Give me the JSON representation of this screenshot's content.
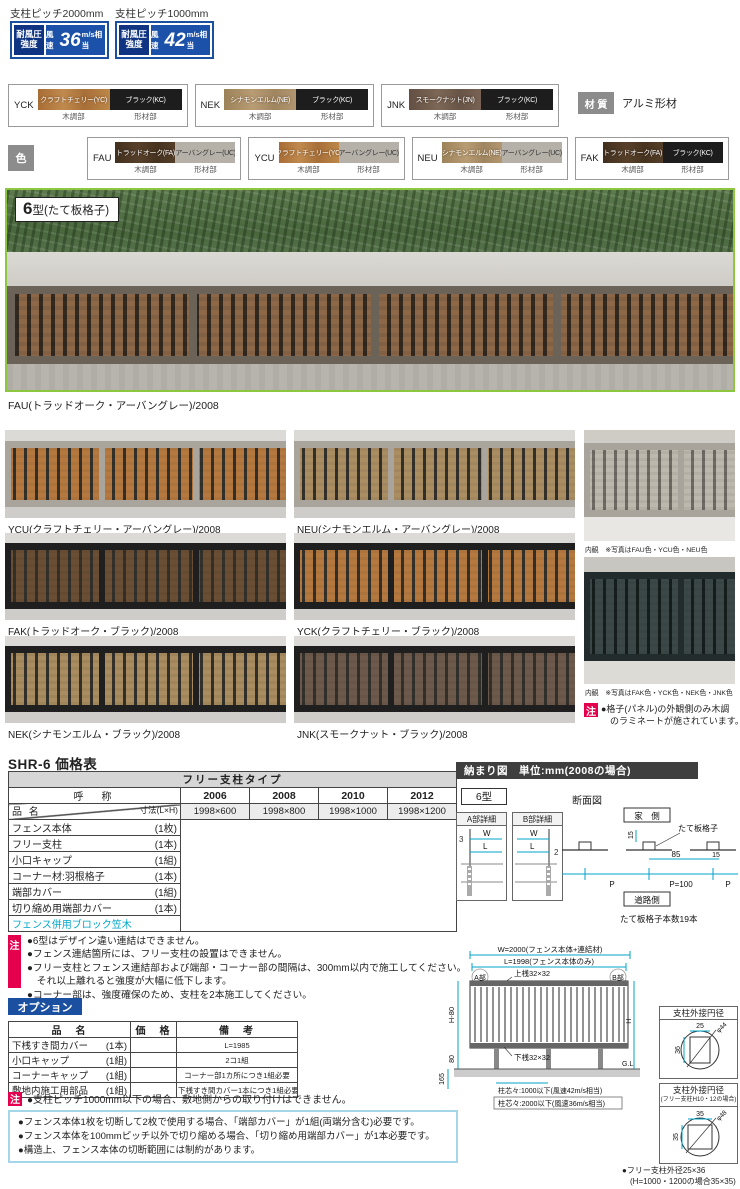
{
  "colors": {
    "badge_blue": "#1b4fa0",
    "badge_blue_dark": "#0f3582",
    "accent_red": "#e5004e",
    "link_cyan": "#00a7c9",
    "dim_cyan": "#00a3c8",
    "photo_frame_green": "#8dc63f",
    "wood_craft_cherry": "#b4793d",
    "wood_cinnamon_elm": "#ac9068",
    "wood_smoke_nut": "#6e5a4b",
    "wood_trad_oak": "#4c3826",
    "urban_gray": "#b5b1a8",
    "black_kc": "#1d1d1d"
  },
  "spec_badges": [
    {
      "pitch": "支柱ピッチ2000mm",
      "label": "耐風圧強度",
      "wind_prefix": "風速",
      "wind_value": "36",
      "wind_unit": "m/s相当"
    },
    {
      "pitch": "支柱ピッチ1000mm",
      "label": "耐風圧強度",
      "wind_prefix": "風速",
      "wind_value": "42",
      "wind_unit": "m/s相当"
    }
  ],
  "material": {
    "label": "材 質",
    "value": "アルミ形材"
  },
  "color_row_label": "色",
  "swatches_row1": [
    {
      "code": "YCK",
      "left": "クラフトチェリー(YC)",
      "right": "ブラック(KC)",
      "left_part": "木調部",
      "right_part": "形材部"
    },
    {
      "code": "NEK",
      "left": "シナモンエルム(NE)",
      "right": "ブラック(KC)",
      "left_part": "木調部",
      "right_part": "形材部"
    },
    {
      "code": "JNK",
      "left": "スモークナット(JN)",
      "right": "ブラック(KC)",
      "left_part": "木調部",
      "right_part": "形材部"
    }
  ],
  "swatches_row2": [
    {
      "code": "FAU",
      "left": "トラッドオーク(FA)",
      "right": "アーバングレー(UC)",
      "left_part": "木調部",
      "right_part": "形材部"
    },
    {
      "code": "YCU",
      "left": "クラフトチェリー(YC)",
      "right": "アーバングレー(UC)",
      "left_part": "木調部",
      "right_part": "形材部"
    },
    {
      "code": "NEU",
      "left": "シナモンエルム(NE)",
      "right": "アーバングレー(UC)",
      "left_part": "木調部",
      "right_part": "形材部"
    },
    {
      "code": "FAK",
      "left": "トラッドオーク(FA)",
      "right": "ブラック(KC)",
      "left_part": "木調部",
      "right_part": "形材部"
    }
  ],
  "series_badge": {
    "number": "6",
    "suffix": "型(たて板格子)"
  },
  "main_photo_caption": "FAU(トラッドオーク・アーバングレー)/2008",
  "photo_grid": [
    {
      "caption": "YCU(クラフトチェリー・アーバングレー)/2008"
    },
    {
      "caption": "NEU(シナモンエルム・アーバングレー)/2008"
    },
    {
      "caption": "FAK(トラッドオーク・ブラック)/2008"
    },
    {
      "caption": "YCK(クラフトチェリー・ブラック)/2008"
    },
    {
      "caption": "NEK(シナモンエルム・ブラック)/2008"
    },
    {
      "caption": "JNK(スモークナット・ブラック)/2008"
    }
  ],
  "interior": {
    "caption1": "内観　※写真はFAU色・YCU色・NEU色",
    "caption2": "内観　※写真はFAK色・YCK色・NEK色・JNK色",
    "note_badge": "注",
    "note_text1": "●格子(パネル)の外観側のみ木調",
    "note_text2": "　のラミネートが施されています。"
  },
  "price_table": {
    "title": "SHR-6 価格表",
    "type_header": "フリー支柱タイプ",
    "name_header": "呼　称",
    "size_header": "寸法(L×H)",
    "item_header": "品 名",
    "codes": [
      "2006",
      "2008",
      "2010",
      "2012"
    ],
    "sizes": [
      "1998×600",
      "1998×800",
      "1998×1000",
      "1998×1200"
    ],
    "items": [
      {
        "name": "フェンス本体",
        "unit": "(1枚)"
      },
      {
        "name": "フリー支柱",
        "unit": "(1本)"
      },
      {
        "name": "小口キャップ",
        "unit": "(1組)"
      },
      {
        "name": "コーナー材:羽根格子",
        "unit": "(1本)"
      },
      {
        "name": "端部カバー",
        "unit": "(1組)"
      },
      {
        "name": "切り縮め用端部カバー",
        "unit": "(1本)"
      }
    ],
    "link_row": "フェンス併用ブロック笠木"
  },
  "layout_diagram": {
    "header": "納まり図　単位:mm(2008の場合)",
    "type_label": "6型",
    "detail_a": {
      "title": "A部詳細",
      "dim": "3",
      "w": "W",
      "l": "L"
    },
    "detail_b": {
      "title": "B部詳細",
      "dim": "2",
      "w": "W",
      "l": "L"
    },
    "section_label": "断面図",
    "house_side": "家　側",
    "grille_label": "たて板格子",
    "dim_15a": "15",
    "dim_85": "85",
    "dim_15b": "15",
    "dim_p1": "P",
    "dim_p100": "P=100",
    "dim_p2": "P",
    "road_side": "道路側",
    "count_note": "たて板格子本数19本"
  },
  "notes": {
    "badge": "注",
    "lines": [
      "●6型はデザイン違い連結はできません。",
      "●フェンス連結箇所には、フリー支柱の設置はできません。",
      "●フリー支柱とフェンス連結部および端部・コーナー部の間隔は、300mm以内で施工してください。",
      "　それ以上離れると強度が大幅に低下します。",
      "●コーナー部は、強度確保のため、支柱を2本施工してください。"
    ]
  },
  "options": {
    "badge": "オプション",
    "headers": {
      "name": "品　名",
      "price": "価　格",
      "note": "備　考"
    },
    "rows": [
      {
        "name": "下桟すき間カバー",
        "unit": "(1本)",
        "price": "",
        "note": "L=1985"
      },
      {
        "name": "小口キャップ",
        "unit": "(1組)",
        "price": "",
        "note": "2コ1組"
      },
      {
        "name": "コーナーキャップ",
        "unit": "(1組)",
        "price": "",
        "note": "コーナー部1カ所につき1組必要"
      },
      {
        "name": "敷地内施工用部品",
        "unit": "(1組)",
        "price": "",
        "note": "下桟すき間カバー1本につき1組必要"
      }
    ],
    "note_badge": "注",
    "note": "●支柱ピッチ1000mm以下の場合、敷地側からの取り付けはできません。"
  },
  "elevation": {
    "w_label": "W=2000(フェンス本体+連結材)",
    "l_label": "L=1998(フェンス本体のみ)",
    "top_rail": "上桟32×32",
    "part_a": "A部",
    "part_b": "B部",
    "h80": "H-80",
    "h": "H",
    "d80": "80",
    "d165": "165",
    "bottom_rail": "下桟32×32",
    "gl": "G.L",
    "pitch_note1": "柱芯々:1000以下(風速42m/s相当)",
    "pitch_note2": "柱芯々:2000以下(風速36m/s相当)"
  },
  "post_diagrams": [
    {
      "title": "支柱外接円径",
      "subtitle": "",
      "w": "25",
      "h": "36",
      "dia": "φ44"
    },
    {
      "title": "支柱外接円径",
      "subtitle": "(フリー支柱H10・12の場合)",
      "w": "35",
      "h": "35",
      "dia": "φ48"
    }
  ],
  "post_note1": "●フリー支柱外径25×36",
  "post_note2": "　(H=1000・1200の場合35×35)",
  "bottom_notes": [
    "●フェンス本体1枚を切断して2枚で使用する場合、「端部カバー」が1組(両端分含む)必要です。",
    "●フェンス本体を100mmピッチ以外で切り縮める場合、「切り縮め用端部カバー」が1本必要です。",
    "●構造上、フェンス本体の切断範囲には制約があります。"
  ]
}
